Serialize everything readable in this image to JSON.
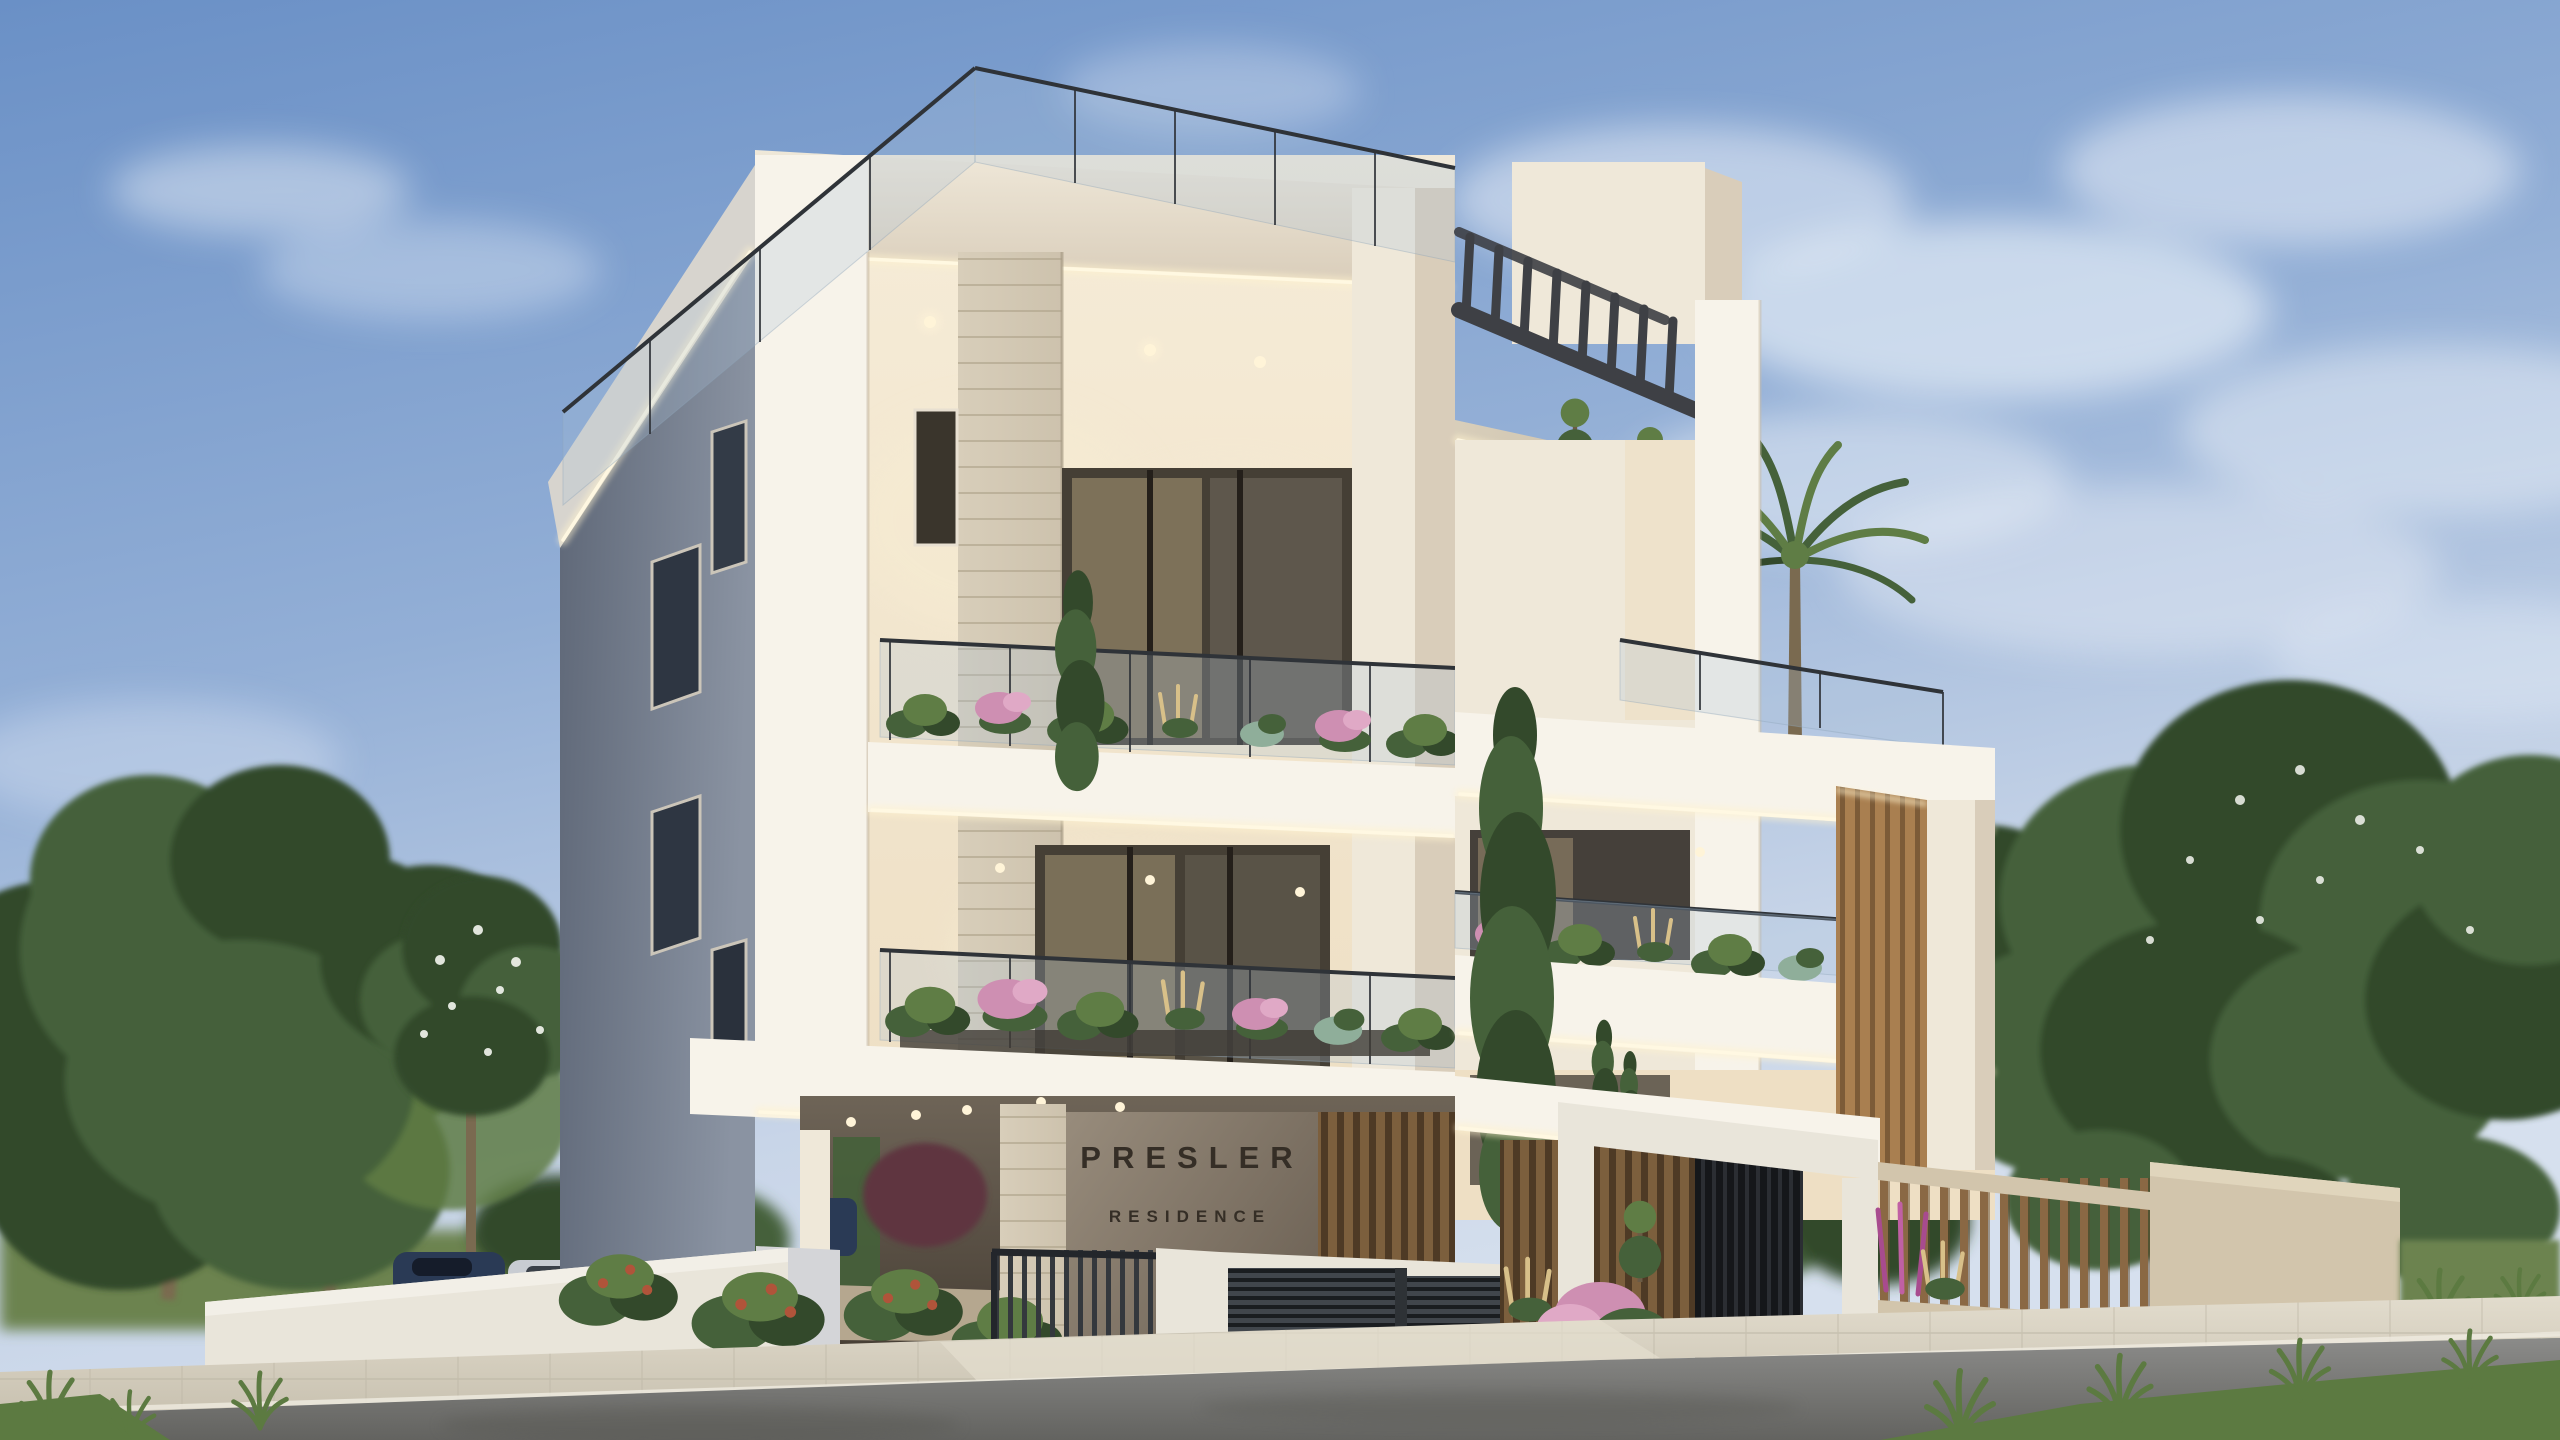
{
  "scene": {
    "description": "Dusk photoreal rendering of a modern four-storey residential building with illuminated soffits, roof terraces, planted balconies, gated parking, slatted fences and street landscaping",
    "time_of_day": "dusk",
    "sign": {
      "title": "PRESLER",
      "subtitle": "RESIDENCE"
    },
    "elements": [
      "main-building-block",
      "right-wing-block",
      "roof-glass-balustrade",
      "rooftop-pergola",
      "stair-bulkhead",
      "palm-tree",
      "cypress-trees",
      "topiary-plants",
      "balcony-planters",
      "led-cove-lighting",
      "stone-clad-columns",
      "timber-louver-column",
      "name-sign-wall",
      "covered-parking",
      "parked-cars",
      "sliding-bar-gate",
      "louvered-fence-panels",
      "timber-picket-fence",
      "entrance-portal",
      "boundary-walls",
      "street-trees",
      "flowering-trees",
      "shrubs",
      "ornamental-grasses",
      "paved-sidewalk",
      "asphalt-road",
      "evening-sky-clouds"
    ],
    "counts": {
      "visible_floors": 4,
      "parked_cars_visible": 4,
      "palm_trees": 1
    }
  },
  "colors": {
    "sky_top": "#6A90C6",
    "sky_mid": "#93AFD6",
    "sky_horizon": "#C8D5E8",
    "cloud": "#F2F6FB",
    "facade_cream": "#EFE8D9",
    "facade_bright": "#F7F3EA",
    "facade_warm": "#EEDFC4",
    "facade_shadow": "#D9CDBA",
    "side_wall_dark": "#5E6777",
    "side_wall_light": "#8A93A2",
    "glass_dark": "#3A352C",
    "glass_warm": "#D3BD92",
    "rail_metal": "#2F3338",
    "glass_tint": "#A9C3D8",
    "led_glow": "#FFF3CF",
    "stone": "#CDC2AD",
    "stone_line": "#B2A68E",
    "sign_wall": "#8D8172",
    "sign_wall_dark": "#6E6356",
    "sign_text": "#352E26",
    "wood": "#A97F50",
    "wood_dark": "#7C5B38",
    "pergola": "#3E4045",
    "leaf_dark": "#33492B",
    "leaf_mid": "#45613A",
    "leaf_light": "#5F7D45",
    "leaf_pink": "#CE8FB2",
    "leaf_pink_light": "#E0A9C6",
    "leaf_wheat": "#D8C089",
    "leaf_blue": "#8FAE9A",
    "grass": "#5C7A41",
    "field": "#6C834F",
    "wall_white": "#E9E5DA",
    "wall_beige": "#D2C5AC",
    "fence_dark": "#34383D",
    "sidewalk": "#D9D3C4",
    "sidewalk_line": "#BCB5A4",
    "road": "#8B8B89",
    "road_dark": "#636360",
    "trunk": "#7A6A50",
    "car_black": "#101113",
    "car_navy": "#2A3A55",
    "car_silver": "#C8CCD2",
    "berry": "#B0543A",
    "blossom": "#F4F6F0"
  }
}
